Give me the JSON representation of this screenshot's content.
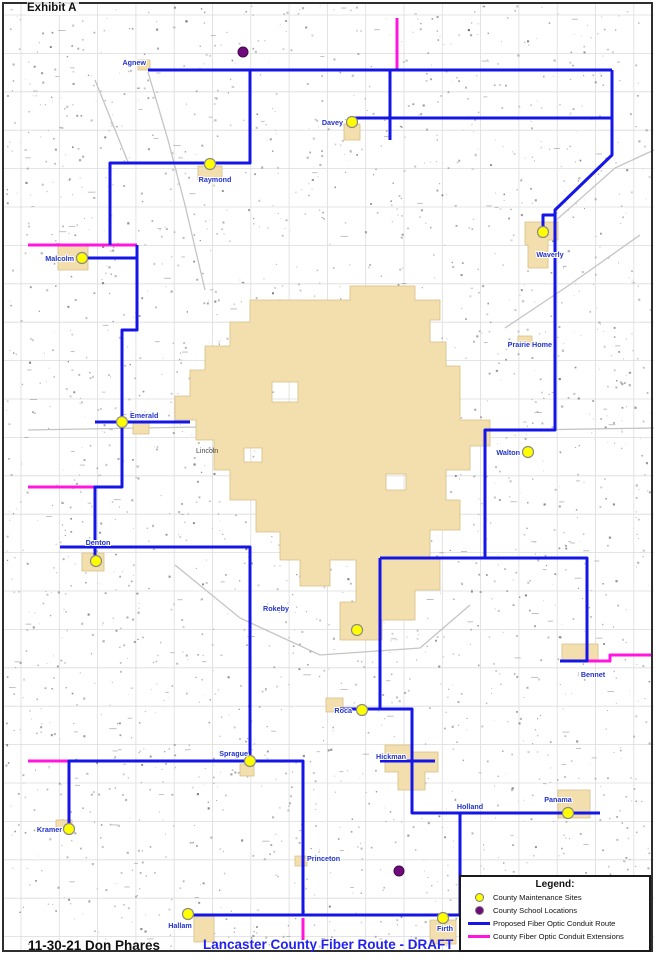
{
  "page": {
    "exhibit_label": "Exhibit A",
    "footer_left": "11-30-21 Don Phares",
    "footer_title": "Lancaster County Fiber Route - DRAFT"
  },
  "legend": {
    "title": "Legend:",
    "items": [
      {
        "id": "maintenance",
        "symbol": "dot",
        "color": "#ffff00",
        "label": "County Maintenance Sites"
      },
      {
        "id": "school",
        "symbol": "dot",
        "color": "#6f0a7d",
        "label": "County School Locations"
      },
      {
        "id": "route",
        "symbol": "line",
        "color": "#1515e8",
        "label": "Proposed Fiber Optic Conduit Route"
      },
      {
        "id": "extension",
        "symbol": "line",
        "color": "#ff14e0",
        "label": "County Fiber Optic Conduit Extensions"
      }
    ]
  },
  "map": {
    "colors": {
      "route_blue": "#1515e8",
      "extension_magenta": "#ff14e0",
      "site_yellow": "#ffff00",
      "school_purple": "#6f0a7d",
      "city_fill": "#f3dfae",
      "city_stroke": "#d6bf85",
      "grid": "#dcdcdc",
      "road": "#c4c4c4",
      "label_blue": "#2233cc"
    },
    "city": {
      "name": "Lincoln",
      "label_x": 196,
      "label_y": 453,
      "outline": [
        250,
        300,
        350,
        300,
        350,
        286,
        415,
        286,
        415,
        300,
        440,
        300,
        440,
        320,
        430,
        320,
        430,
        342,
        446,
        342,
        446,
        366,
        460,
        366,
        460,
        420,
        490,
        420,
        490,
        446,
        470,
        446,
        470,
        470,
        446,
        470,
        446,
        500,
        460,
        500,
        460,
        530,
        430,
        530,
        430,
        558,
        440,
        558,
        440,
        590,
        415,
        590,
        415,
        620,
        382,
        620,
        382,
        640,
        340,
        640,
        340,
        602,
        356,
        602,
        356,
        560,
        330,
        560,
        330,
        586,
        300,
        586,
        300,
        560,
        280,
        560,
        280,
        532,
        256,
        532,
        256,
        500,
        230,
        500,
        230,
        470,
        214,
        470,
        214,
        440,
        196,
        440,
        196,
        420,
        175,
        420,
        175,
        396,
        190,
        396,
        190,
        370,
        205,
        370,
        205,
        346,
        230,
        346,
        230,
        322,
        250,
        322
      ],
      "holes": [
        [
          272,
          382,
          26,
          20
        ],
        [
          386,
          474,
          20,
          16
        ],
        [
          244,
          448,
          18,
          14
        ]
      ]
    },
    "towns": [
      {
        "name": "Waverly",
        "shape": [
          525,
          222,
          558,
          222,
          558,
          240,
          548,
          240,
          548,
          268,
          528,
          268,
          528,
          245,
          525,
          245
        ]
      },
      {
        "name": "Davey",
        "shape": [
          344,
          124,
          360,
          124,
          360,
          140,
          344,
          140
        ]
      },
      {
        "name": "Raymond",
        "shape": [
          198,
          166,
          222,
          166,
          222,
          180,
          198,
          180
        ]
      },
      {
        "name": "Malcolm",
        "shape": [
          58,
          246,
          88,
          246,
          88,
          270,
          58,
          270
        ]
      },
      {
        "name": "Emerald",
        "shape": [
          133,
          421,
          149,
          421,
          149,
          434,
          133,
          434
        ]
      },
      {
        "name": "Denton",
        "shape": [
          82,
          553,
          104,
          553,
          104,
          571,
          82,
          571
        ]
      },
      {
        "name": "Roca",
        "shape": [
          326,
          698,
          343,
          698,
          343,
          712,
          326,
          712
        ]
      },
      {
        "name": "Sprague",
        "shape": [
          240,
          764,
          254,
          764,
          254,
          776,
          240,
          776
        ]
      },
      {
        "name": "Hickman",
        "shape": [
          385,
          745,
          412,
          745,
          412,
          752,
          438,
          752,
          438,
          772,
          425,
          772,
          425,
          790,
          398,
          790,
          398,
          772,
          385,
          772
        ]
      },
      {
        "name": "Bennet",
        "shape": [
          562,
          644,
          598,
          644,
          598,
          660,
          562,
          660
        ]
      },
      {
        "name": "Panama",
        "shape": [
          558,
          790,
          590,
          790,
          590,
          818,
          558,
          818
        ]
      },
      {
        "name": "Kramer",
        "shape": [
          56,
          820,
          72,
          820,
          72,
          830,
          56,
          830
        ]
      },
      {
        "name": "Princeton",
        "shape": [
          295,
          856,
          307,
          856,
          307,
          866,
          295,
          866
        ]
      },
      {
        "name": "Hallam",
        "shape": [
          194,
          916,
          214,
          916,
          214,
          942,
          194,
          942
        ]
      },
      {
        "name": "Firth",
        "shape": [
          430,
          920,
          456,
          920,
          456,
          944,
          430,
          944
        ]
      },
      {
        "name": "Prairie Home",
        "shape": [
          518,
          336,
          532,
          336,
          532,
          346,
          518,
          346
        ]
      },
      {
        "name": "Agnew",
        "shape": [
          138,
          60,
          150,
          60,
          150,
          70,
          138,
          70
        ]
      }
    ],
    "maintenance_sites": [
      {
        "name": "Davey",
        "x": 352,
        "y": 122,
        "lx": 343,
        "ly": 125,
        "anchor": "end"
      },
      {
        "name": "Raymond",
        "x": 210,
        "y": 164,
        "lx": 215,
        "ly": 182,
        "anchor": "middle"
      },
      {
        "name": "Malcolm",
        "x": 82,
        "y": 258,
        "lx": 74,
        "ly": 261,
        "anchor": "end"
      },
      {
        "name": "Waverly",
        "x": 543,
        "y": 232,
        "lx": 550,
        "ly": 257,
        "anchor": "middle"
      },
      {
        "name": "Emerald",
        "x": 122,
        "y": 422,
        "lx": 130,
        "ly": 418,
        "anchor": "start"
      },
      {
        "name": "Walton",
        "x": 528,
        "y": 452,
        "lx": 520,
        "ly": 455,
        "anchor": "end"
      },
      {
        "name": "Denton",
        "x": 96,
        "y": 561,
        "lx": 98,
        "ly": 545,
        "anchor": "middle"
      },
      {
        "name": "",
        "x": 357,
        "y": 630,
        "lx": 0,
        "ly": 0,
        "anchor": "middle"
      },
      {
        "name": "Roca",
        "x": 362,
        "y": 710,
        "lx": 352,
        "ly": 713,
        "anchor": "end"
      },
      {
        "name": "Sprague",
        "x": 250,
        "y": 761,
        "lx": 248,
        "ly": 756,
        "anchor": "end"
      },
      {
        "name": "Panama",
        "x": 568,
        "y": 813,
        "lx": 558,
        "ly": 802,
        "anchor": "middle"
      },
      {
        "name": "Kramer",
        "x": 69,
        "y": 829,
        "lx": 62,
        "ly": 832,
        "anchor": "end"
      },
      {
        "name": "Hallam",
        "x": 188,
        "y": 914,
        "lx": 180,
        "ly": 928,
        "anchor": "middle"
      },
      {
        "name": "Firth",
        "x": 443,
        "y": 918,
        "lx": 445,
        "ly": 931,
        "anchor": "middle"
      }
    ],
    "school_locations": [
      {
        "x": 243,
        "y": 52
      },
      {
        "x": 399,
        "y": 871
      }
    ],
    "place_labels": [
      {
        "name": "Agnew",
        "x": 146,
        "y": 65,
        "anchor": "end"
      },
      {
        "name": "Prairie Home",
        "x": 552,
        "y": 347,
        "anchor": "end"
      },
      {
        "name": "Rokeby",
        "x": 263,
        "y": 611,
        "anchor": "start"
      },
      {
        "name": "Hickman",
        "x": 406,
        "y": 759,
        "anchor": "end"
      },
      {
        "name": "Holland",
        "x": 470,
        "y": 809,
        "anchor": "middle"
      },
      {
        "name": "Bennet",
        "x": 593,
        "y": 677,
        "anchor": "middle"
      },
      {
        "name": "Princeton",
        "x": 307,
        "y": 861,
        "anchor": "start"
      }
    ],
    "blue_routes": [
      [
        148,
        70,
        612,
        70
      ],
      [
        612,
        70,
        612,
        155,
        555,
        210,
        555,
        430,
        485,
        430,
        485,
        558,
        587,
        558,
        587,
        661,
        560,
        661
      ],
      [
        352,
        118,
        612,
        118
      ],
      [
        390,
        70,
        390,
        140
      ],
      [
        555,
        215,
        543,
        215,
        543,
        232
      ],
      [
        250,
        70,
        250,
        163,
        110,
        163,
        110,
        245
      ],
      [
        137,
        245,
        137,
        258,
        82,
        258
      ],
      [
        137,
        245,
        137,
        330,
        122,
        330,
        122,
        422,
        122,
        487,
        95,
        487,
        95,
        561
      ],
      [
        95,
        422,
        190,
        422
      ],
      [
        60,
        547,
        250,
        547,
        250,
        761,
        69,
        761,
        69,
        829
      ],
      [
        250,
        761,
        303,
        761,
        303,
        915
      ],
      [
        188,
        915,
        460,
        915
      ],
      [
        460,
        915,
        460,
        813
      ],
      [
        380,
        558,
        380,
        709
      ],
      [
        485,
        558,
        380,
        558
      ],
      [
        340,
        709,
        412,
        709,
        412,
        813,
        568,
        813,
        600,
        813
      ],
      [
        380,
        761,
        435,
        761
      ]
    ],
    "magenta_routes": [
      [
        397,
        18,
        397,
        70
      ],
      [
        28,
        245,
        137,
        245
      ],
      [
        28,
        487,
        95,
        487
      ],
      [
        28,
        761,
        69,
        761
      ],
      [
        587,
        661,
        610,
        661,
        610,
        655,
        652,
        655
      ],
      [
        303,
        918,
        303,
        940
      ]
    ]
  }
}
